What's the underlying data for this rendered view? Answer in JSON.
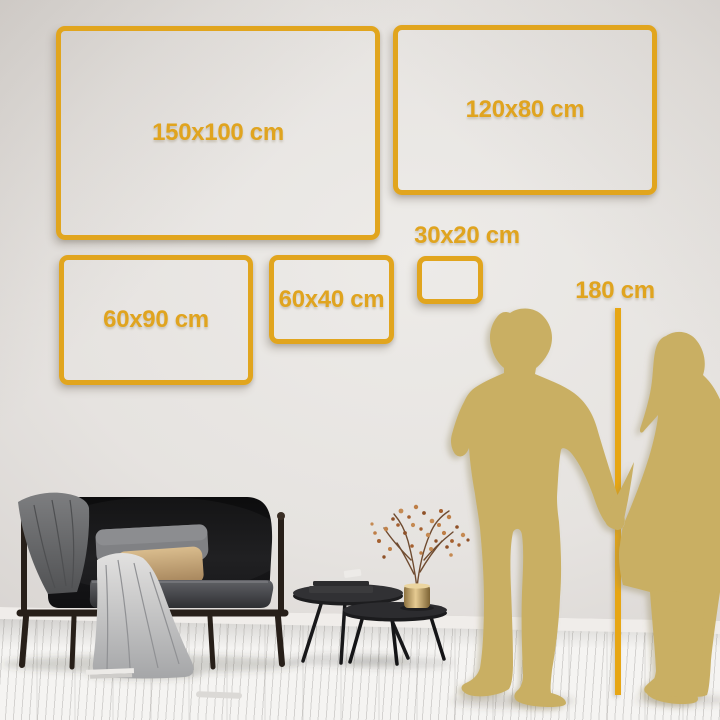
{
  "diagram": {
    "frames": [
      {
        "id": "150x100",
        "label": "150x100 cm"
      },
      {
        "id": "120x80",
        "label": "120x80 cm"
      },
      {
        "id": "60x90",
        "label": "60x90 cm"
      },
      {
        "id": "60x40",
        "label": "60x40 cm"
      },
      {
        "id": "30x20",
        "label": "30x20 cm"
      }
    ],
    "height_reference": {
      "label": "180 cm"
    },
    "colors": {
      "accent_gold": "#E1A51E",
      "silhouette_gold": "#C9AF63"
    }
  }
}
